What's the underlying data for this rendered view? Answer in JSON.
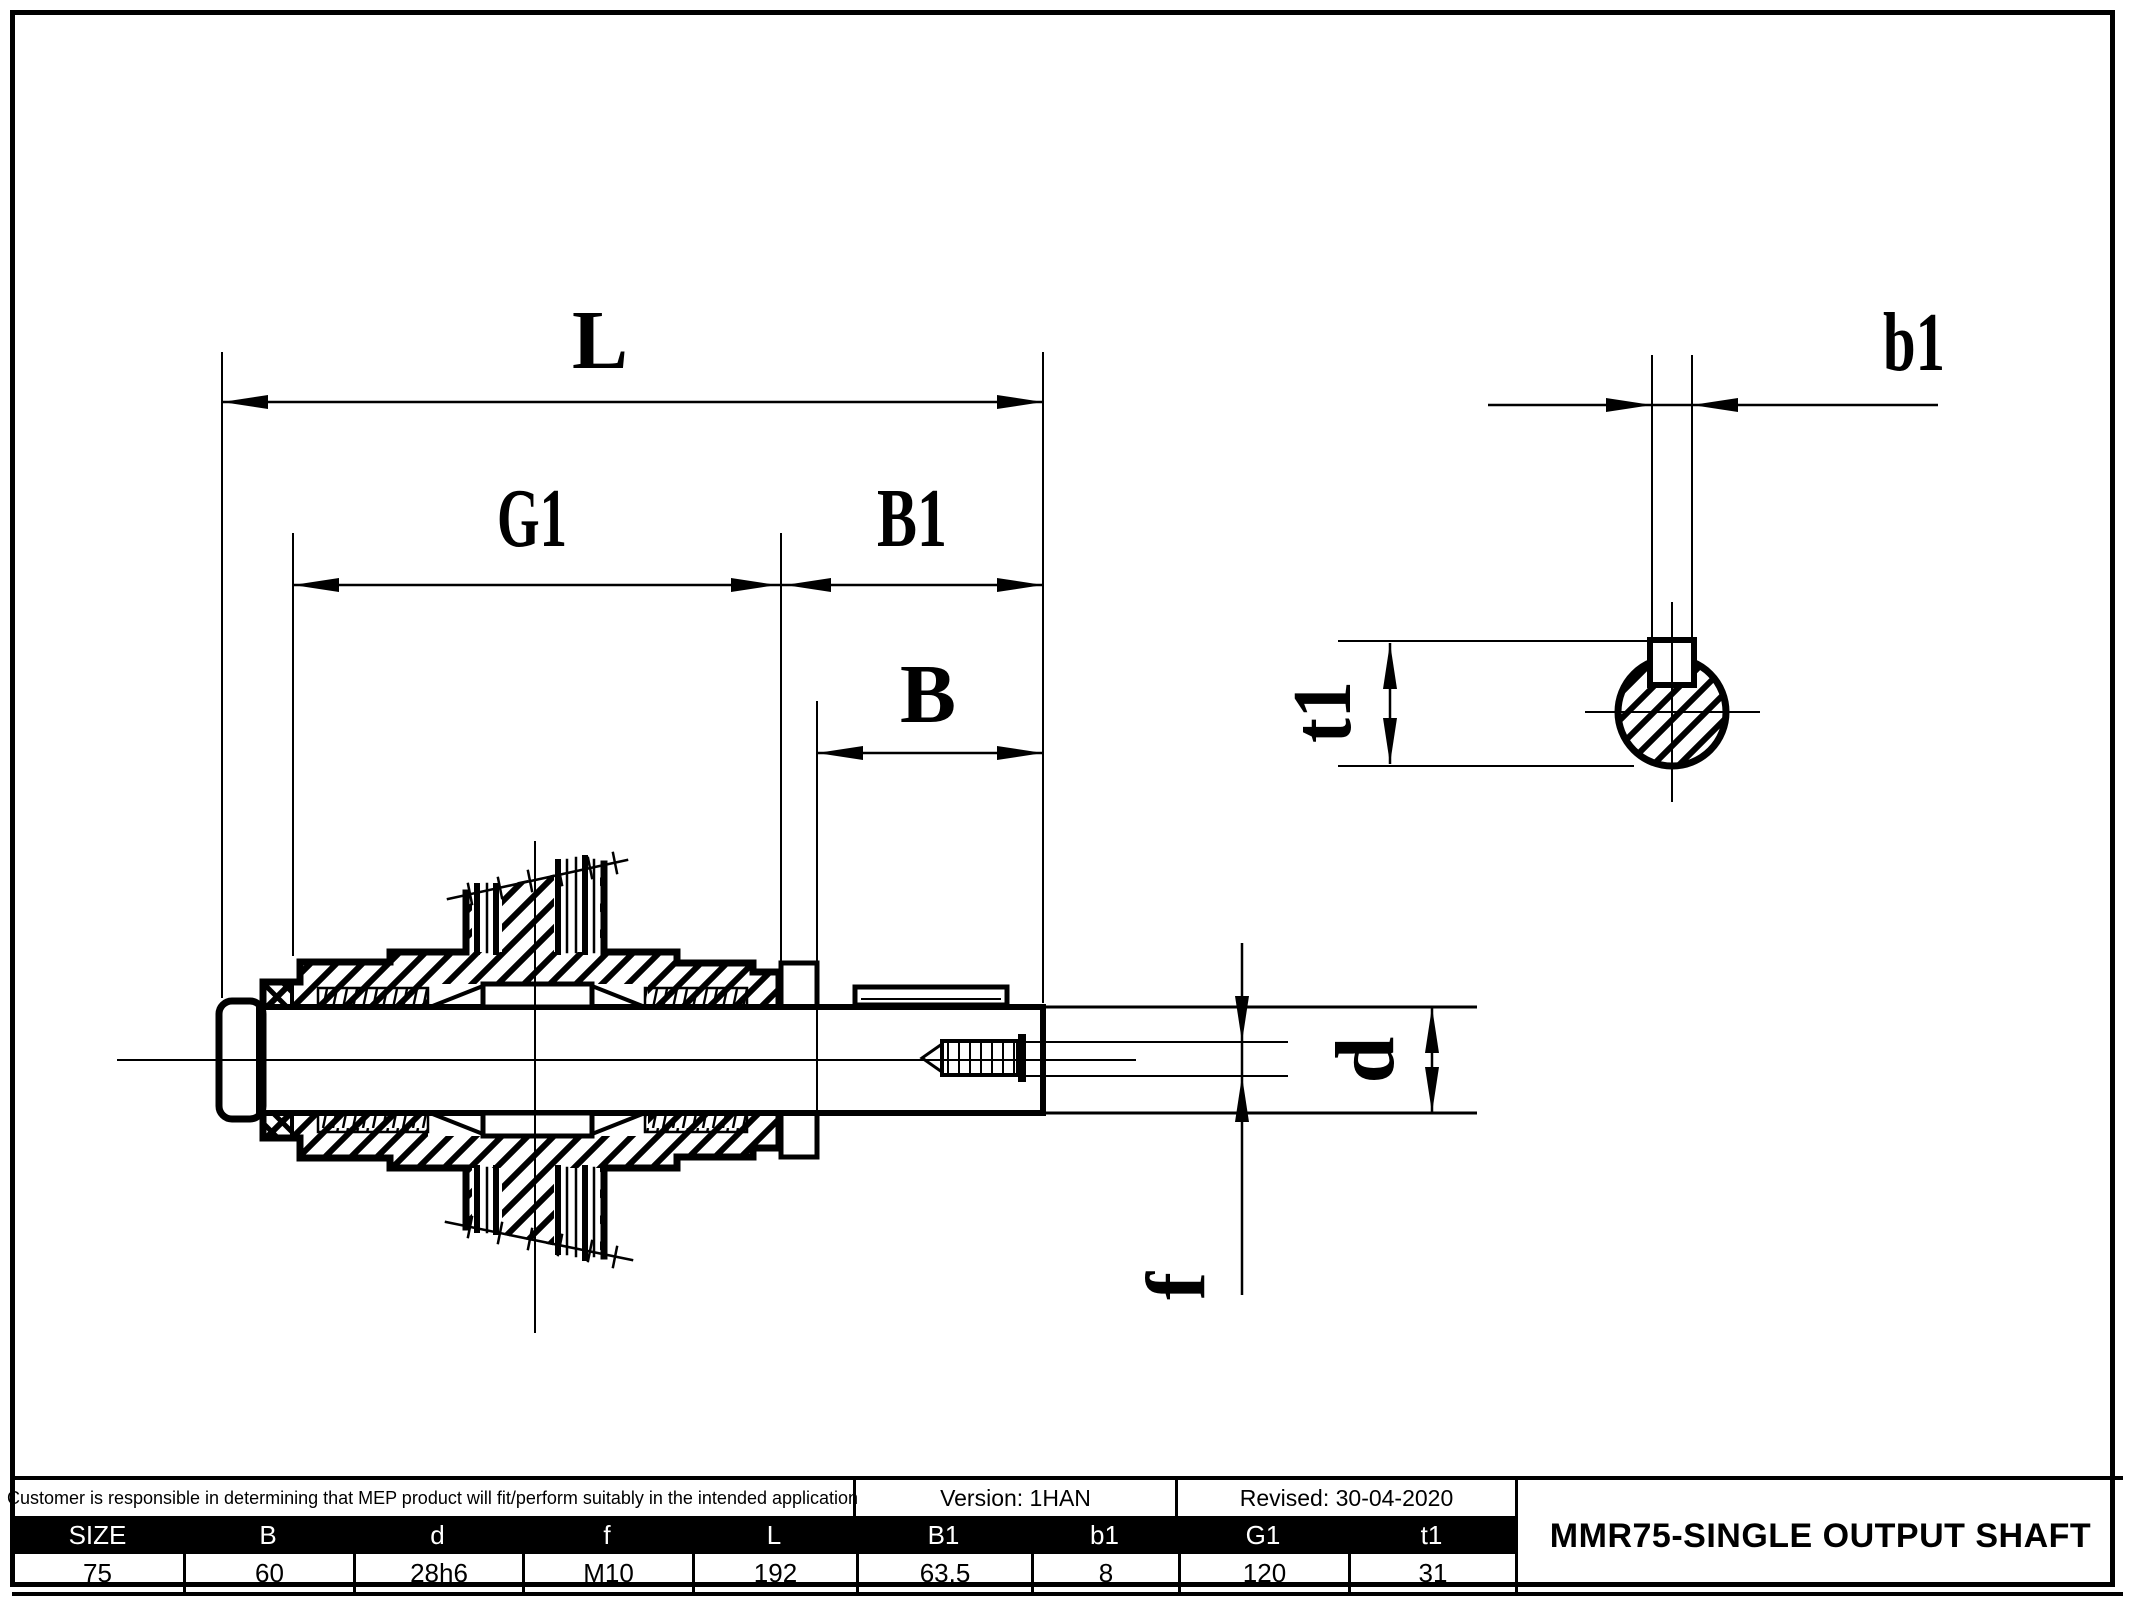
{
  "page": {
    "background": "#ffffff",
    "line_color": "#000000"
  },
  "drawing": {
    "dim_labels": {
      "L": "L",
      "G1": "G1",
      "B1": "B1",
      "B": "B",
      "d": "d",
      "f": "f",
      "b1": "b1",
      "t1": "t1"
    }
  },
  "title_block": {
    "note": "Customer is responsible in determining that MEP product will fit/perform suitably in the intended application",
    "version": "Version: 1HAN",
    "revised": "Revised: 30-04-2020",
    "title": "MMR75-SINGLE OUTPUT SHAFT",
    "columns": [
      {
        "header": "SIZE",
        "value": "75"
      },
      {
        "header": "B",
        "value": "60"
      },
      {
        "header": "d",
        "value": "28h6"
      },
      {
        "header": "f",
        "value": "M10"
      },
      {
        "header": "L",
        "value": "192"
      },
      {
        "header": "B1",
        "value": "63.5"
      },
      {
        "header": "b1",
        "value": "8"
      },
      {
        "header": "G1",
        "value": "120"
      },
      {
        "header": "t1",
        "value": "31"
      }
    ]
  }
}
